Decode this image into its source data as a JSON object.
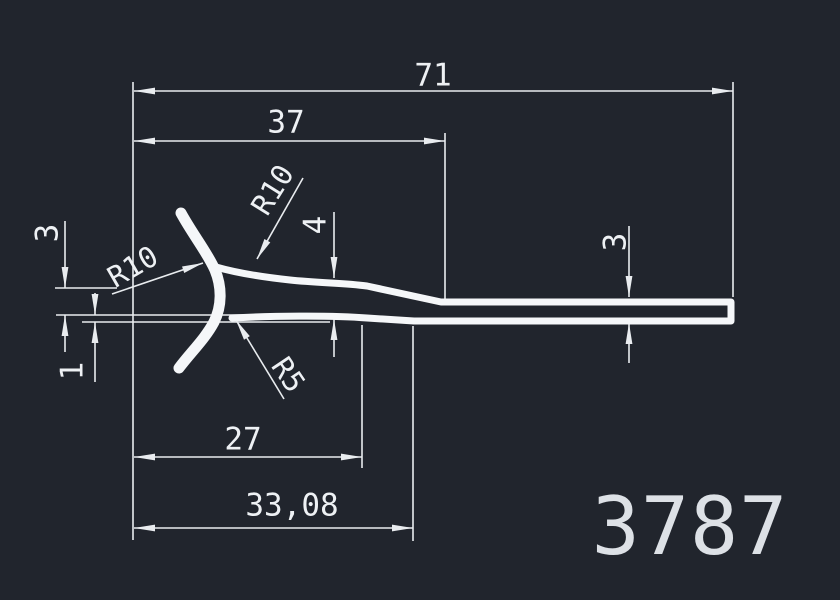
{
  "drawing": {
    "title": "extrusion-profile-drawing",
    "part_number": "3787",
    "units_style": "mm, comma decimal separator"
  },
  "colors": {
    "background": "#21252d",
    "thin_line": "#e9ecef",
    "profile_line": "#f5f7f9",
    "dim_text": "#eef1f4",
    "part_text": "#dde1e6"
  },
  "labels": {
    "dim71": {
      "text": "71"
    },
    "dim37": {
      "text": "37"
    },
    "dim27": {
      "text": "27"
    },
    "dim33_08": {
      "text": "33,08"
    },
    "dim3_left": {
      "text": "3"
    },
    "dim1": {
      "text": "1"
    },
    "dim4": {
      "text": "4"
    },
    "dim3_right": {
      "text": "3"
    },
    "r10_upper": {
      "text": "R10"
    },
    "r10_left": {
      "text": "R10"
    },
    "r5": {
      "text": "R5"
    },
    "part_number": {
      "text": "3787"
    }
  },
  "dimensions": [
    {
      "label": "71",
      "kind": "horizontal-length"
    },
    {
      "label": "37",
      "kind": "horizontal-length"
    },
    {
      "label": "27",
      "kind": "horizontal-length"
    },
    {
      "label": "33,08",
      "kind": "horizontal-length"
    },
    {
      "label": "3",
      "kind": "vertical-thickness-left"
    },
    {
      "label": "1",
      "kind": "vertical-thickness-left"
    },
    {
      "label": "4",
      "kind": "vertical-thickness-mid"
    },
    {
      "label": "3",
      "kind": "vertical-thickness-right"
    },
    {
      "label": "R10",
      "kind": "radius-upper-fillet"
    },
    {
      "label": "R10",
      "kind": "radius-left-fillet"
    },
    {
      "label": "R5",
      "kind": "radius-lower-fillet"
    }
  ],
  "geometry": {
    "thin_width": 1.6,
    "thin_lines": [
      [
        133,
        82,
        133,
        540
      ],
      [
        733,
        82,
        733,
        297
      ],
      [
        445,
        133,
        445,
        299
      ],
      [
        362,
        325,
        362,
        468
      ],
      [
        413,
        326,
        413,
        541
      ],
      [
        55,
        288,
        117,
        288
      ],
      [
        56,
        315,
        300,
        315
      ],
      [
        82,
        322,
        330,
        322
      ],
      [
        134,
        91,
        733,
        91
      ],
      [
        134,
        141,
        445,
        141
      ],
      [
        134,
        457,
        362,
        457
      ],
      [
        134,
        528,
        413,
        528
      ],
      [
        65,
        221,
        65,
        288
      ],
      [
        65,
        315,
        65,
        352
      ],
      [
        95,
        293,
        95,
        315
      ],
      [
        95,
        322,
        95,
        382
      ],
      [
        334,
        212,
        334,
        278
      ],
      [
        334,
        319,
        334,
        357
      ],
      [
        629,
        226,
        629,
        297
      ],
      [
        629,
        323,
        629,
        363
      ],
      [
        303,
        178,
        257,
        259
      ],
      [
        112,
        294,
        203,
        263
      ],
      [
        284,
        399,
        236,
        320
      ]
    ],
    "arrows": [
      [
        134,
        91,
        180
      ],
      [
        733,
        91,
        0
      ],
      [
        134,
        141,
        180
      ],
      [
        445,
        141,
        0
      ],
      [
        134,
        457,
        180
      ],
      [
        362,
        457,
        0
      ],
      [
        134,
        528,
        180
      ],
      [
        413,
        528,
        0
      ],
      [
        65,
        288,
        90
      ],
      [
        65,
        315,
        270
      ],
      [
        95,
        315,
        90
      ],
      [
        95,
        322,
        270
      ],
      [
        334,
        278,
        90
      ],
      [
        334,
        319,
        270
      ],
      [
        629,
        297,
        90
      ],
      [
        629,
        323,
        270
      ],
      [
        257,
        259,
        119.6
      ],
      [
        203,
        263,
        -18.8
      ],
      [
        236,
        320,
        -121.3
      ]
    ],
    "profile_paths": [
      {
        "d": "M 181 213 C 193 235 207 252 215 270 C 222 287 222 306 214 322 C 205 339 191 352 179 368",
        "w": 11
      },
      {
        "d": "M 216 267 C 237 273 262 277 290 280 C 318 283 345 283 367 286 L 441 302 L 731 302 L 731 321 L 414 321 L 367 318 C 330 315 268 316 232 318",
        "w": 7
      }
    ]
  }
}
